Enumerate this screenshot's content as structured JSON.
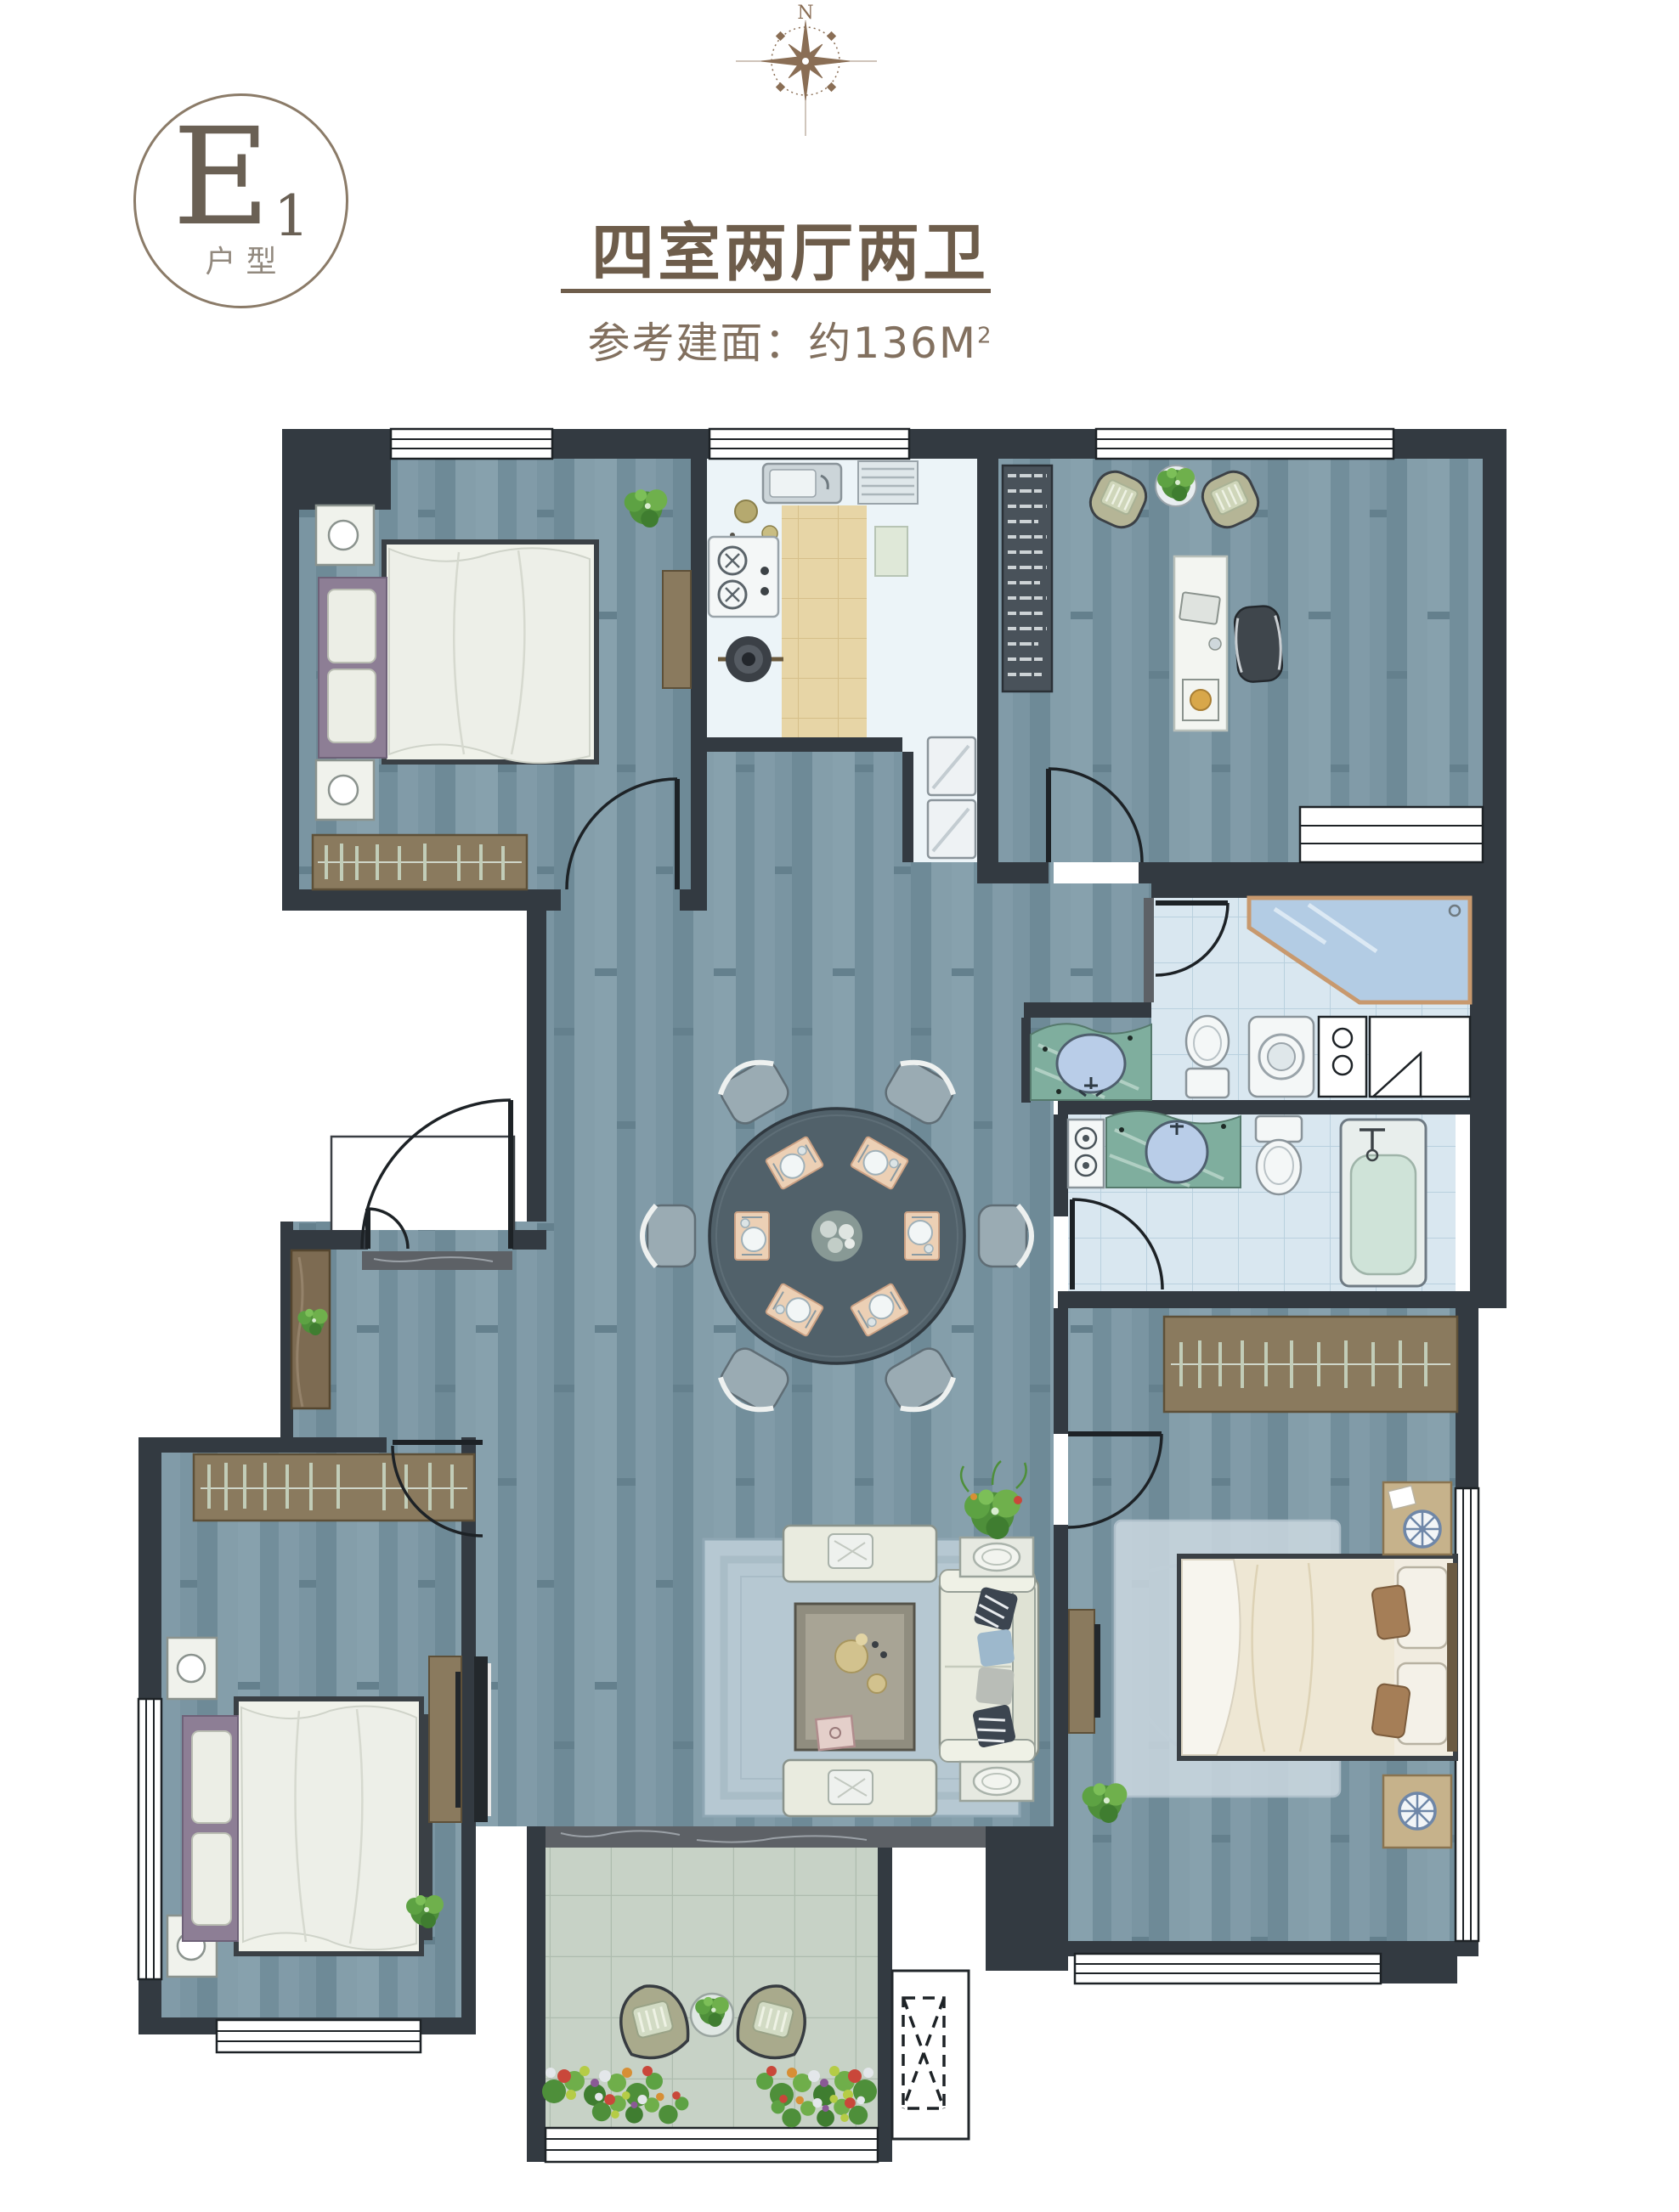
{
  "badge": {
    "letter": "E",
    "subscript": "1",
    "label": "户型"
  },
  "header": {
    "title": "四室两厅两卫",
    "subtitle_prefix": "参考建面：约",
    "area_value": "136",
    "area_unit": "M",
    "area_exponent": "2"
  },
  "compass": {
    "label": "N"
  },
  "colors": {
    "accent_brown": "#6e5d4b",
    "badge_border": "#8b7b68",
    "subtitle_brown": "#82705f",
    "compass_brown": "#8a6e55",
    "wall": "#333a41",
    "wood_floor": "#7e98a5",
    "kitchen_floor": "#ecf4f8",
    "kitchen_tile": "#e7d5a6",
    "bath_tile": "#d9e7f0",
    "balcony_tile": "#c7d2c6",
    "marble": "#5d6166",
    "furniture_white": "#f0f2ec",
    "headboard_purple": "#8d7e95",
    "wardrobe_brown": "#8a7a5e",
    "sofa_cream": "#e9ebdf",
    "dining_table": "#51616a",
    "plant_green": "#5fa24a"
  },
  "floorplan": {
    "elements": [
      "bedroom-top-left",
      "kitchen",
      "study",
      "entry-hall",
      "dining-area",
      "living-room",
      "bedroom-bottom-left",
      "master-bedroom",
      "bathroom-shared",
      "bathroom-ensuite",
      "hall-vanity",
      "balcony",
      "elevator-shaft",
      "dining-table-six-seats",
      "north-compass"
    ]
  }
}
